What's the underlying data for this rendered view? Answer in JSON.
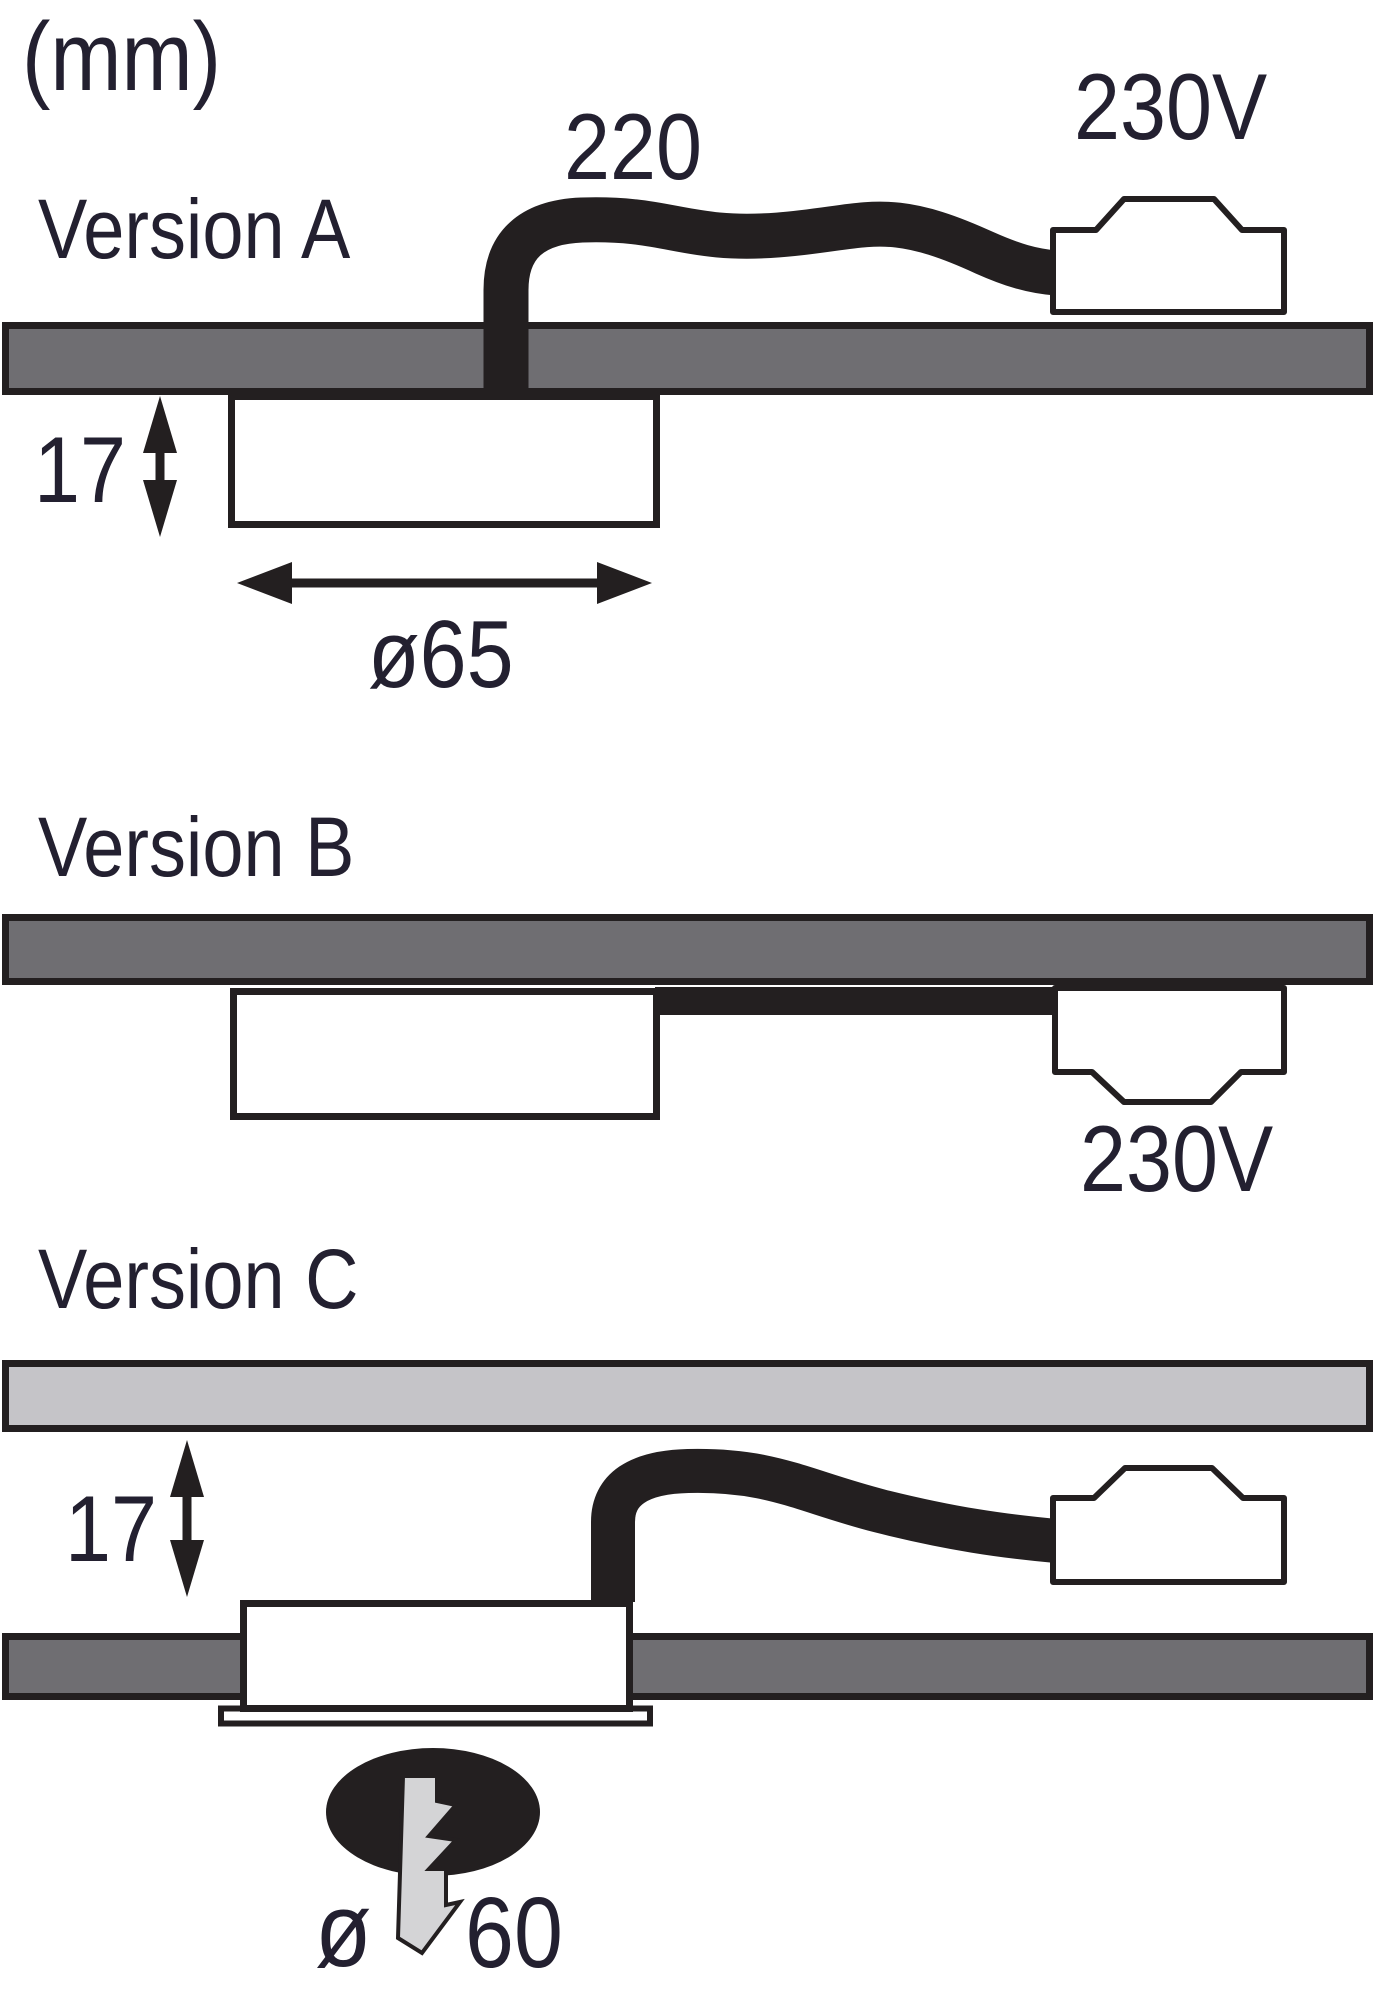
{
  "unit_label": "(mm)",
  "colors": {
    "line_black": "#231f20",
    "panel_dark_gray": "#6f6e72",
    "panel_light_gray": "#c5c4c8",
    "bolt_gray": "#d4d4d6",
    "text": "#232030",
    "background": "#ffffff"
  },
  "sections": {
    "version_a": {
      "title": "Version A",
      "cable_length_label": "220",
      "voltage_label": "230V",
      "mount_depth_label": "17",
      "diameter_label": "ø65"
    },
    "version_b": {
      "title": "Version B",
      "voltage_label": "230V"
    },
    "version_c": {
      "title": "Version C",
      "clearance_label": "17",
      "diameter_symbol": "ø",
      "diameter_value": "60"
    }
  },
  "icons": {
    "lightning_bolt": "light-output / electric symbol inside light beam ellipse"
  }
}
